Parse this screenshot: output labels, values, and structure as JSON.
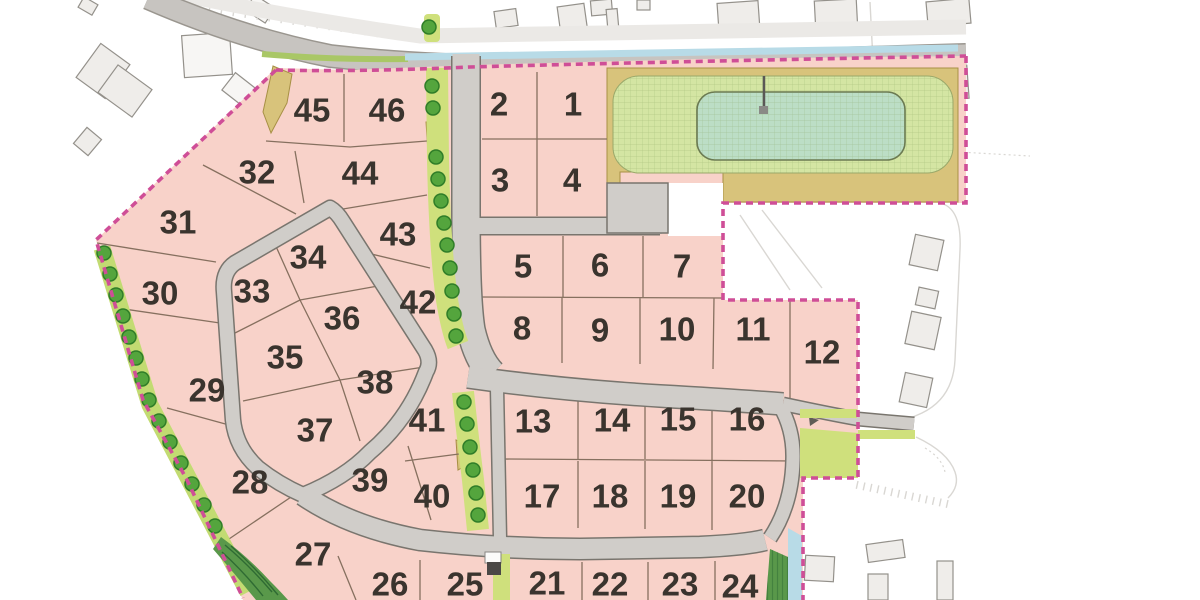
{
  "site_plan": {
    "lot_numbers": [
      "1",
      "2",
      "3",
      "4",
      "5",
      "6",
      "7",
      "8",
      "9",
      "10",
      "11",
      "12",
      "13",
      "14",
      "15",
      "16",
      "17",
      "18",
      "19",
      "20",
      "21",
      "22",
      "23",
      "24",
      "25",
      "26",
      "27",
      "28",
      "29",
      "30",
      "31",
      "32",
      "33",
      "34",
      "35",
      "36",
      "37",
      "38",
      "39",
      "40",
      "41",
      "42",
      "43",
      "44",
      "45",
      "46"
    ],
    "icons": [
      "tree-icon",
      "pond-icon",
      "hedge-icon",
      "utility-box-icon",
      "flow-arrow-icon"
    ],
    "colors": {
      "background": "#ffffff",
      "lot_fill": "#f8d2c9",
      "lot_line": "#86705f",
      "road_fill": "#d0cdc9",
      "road_casing": "#79756e",
      "main_road": "#c7c4c0",
      "main_road_edge": "#9a968f",
      "footway": "#ebe9e6",
      "green_strip": "#cfe07c",
      "boundary_green": "#c2db72",
      "verge": "#a9c766",
      "tree_fill": "#54a53d",
      "tree_edge": "#2f7d28",
      "hedge": "#59984a",
      "hedge_dark": "#2f6b33",
      "tan": "#d8c37b",
      "tan_edge": "#a79045",
      "pond_outer": "#d4e5a3",
      "pond_inner": "#bcdec6",
      "pond_edge": "#6b7a52",
      "water": "#b8dbe7",
      "boundary_dash": "#cf4e97",
      "building": "#efedea",
      "building_white": "#f7f6f4",
      "building_edge": "#94918b",
      "faint": "#d9d7d3",
      "label": "#3a342e"
    }
  }
}
